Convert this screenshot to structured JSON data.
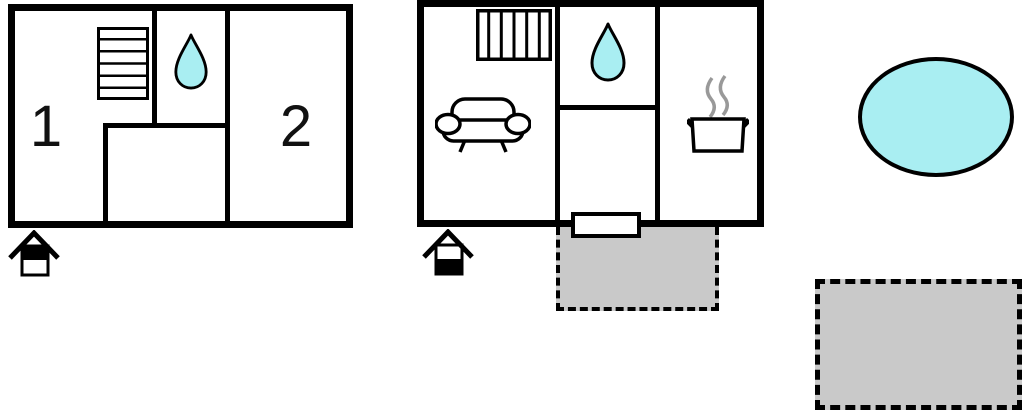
{
  "colors": {
    "wall": "#000000",
    "water": "#a9eef2",
    "gray": "#c9c9c9",
    "steam": "#999999",
    "bg": "#ffffff"
  },
  "upper_floor": {
    "rooms": [
      {
        "label": "1"
      },
      {
        "label": "2"
      }
    ],
    "features": [
      "staircase",
      "water-drop-bathroom"
    ],
    "floor_indicator": "top-half-filled-house"
  },
  "ground_floor": {
    "features": [
      "staircase",
      "water-drop-bathroom",
      "sofa",
      "cooking-pot",
      "entrance-door",
      "attached-terrace"
    ],
    "floor_indicator": "bottom-half-filled-house"
  },
  "outdoor": {
    "pond": {
      "shape": "ellipse",
      "fill": "#a9eef2"
    },
    "patio": {
      "shape": "dashed-rectangle",
      "fill": "#c9c9c9"
    }
  }
}
